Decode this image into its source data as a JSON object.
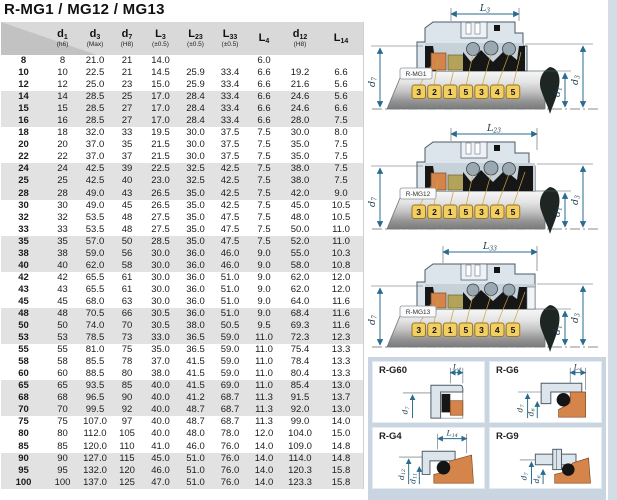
{
  "title": "R-MG1 / MG12 / MG13",
  "table": {
    "columns": [
      {
        "sym": "d",
        "sub": "1",
        "tol": "(h6)"
      },
      {
        "sym": "d",
        "sub": "3",
        "tol": "(Max)"
      },
      {
        "sym": "d",
        "sub": "7",
        "tol": "(H8)"
      },
      {
        "sym": "L",
        "sub": "3",
        "tol": "(±0.5)"
      },
      {
        "sym": "L",
        "sub": "23",
        "tol": "(±0.5)"
      },
      {
        "sym": "L",
        "sub": "33",
        "tol": "(±0.5)"
      },
      {
        "sym": "L",
        "sub": "4",
        "tol": ""
      },
      {
        "sym": "d",
        "sub": "12",
        "tol": "(H8)"
      },
      {
        "sym": "L",
        "sub": "14",
        "tol": ""
      }
    ],
    "rows": [
      {
        "label": "8",
        "values": [
          "8",
          "21.0",
          "21",
          "14.0",
          "",
          "",
          "6.0",
          "",
          ""
        ]
      },
      {
        "label": "10",
        "values": [
          "10",
          "22.5",
          "21",
          "14.5",
          "25.9",
          "33.4",
          "6.6",
          "19.2",
          "6.6"
        ]
      },
      {
        "label": "12",
        "values": [
          "12",
          "25.0",
          "23",
          "15.0",
          "25.9",
          "33.4",
          "6.6",
          "21.6",
          "5.6"
        ]
      },
      {
        "label": "14",
        "values": [
          "14",
          "28.5",
          "25",
          "17.0",
          "28.4",
          "33.4",
          "6.6",
          "24.6",
          "5.6"
        ]
      },
      {
        "label": "15",
        "values": [
          "15",
          "28.5",
          "27",
          "17.0",
          "28.4",
          "33.4",
          "6.6",
          "24.6",
          "6.6"
        ]
      },
      {
        "label": "16",
        "values": [
          "16",
          "28.5",
          "27",
          "17.0",
          "28.4",
          "33.4",
          "6.6",
          "28.0",
          "7.5"
        ]
      },
      {
        "label": "18",
        "values": [
          "18",
          "32.0",
          "33",
          "19.5",
          "30.0",
          "37.5",
          "7.5",
          "30.0",
          "8.0"
        ]
      },
      {
        "label": "20",
        "values": [
          "20",
          "37.0",
          "35",
          "21.5",
          "30.0",
          "37.5",
          "7.5",
          "35.0",
          "7.5"
        ]
      },
      {
        "label": "22",
        "values": [
          "22",
          "37.0",
          "37",
          "21.5",
          "30.0",
          "37.5",
          "7.5",
          "35.0",
          "7.5"
        ]
      },
      {
        "label": "24",
        "values": [
          "24",
          "42.5",
          "39",
          "22.5",
          "32.5",
          "42.5",
          "7.5",
          "38.0",
          "7.5"
        ]
      },
      {
        "label": "25",
        "values": [
          "25",
          "42.5",
          "40",
          "23.0",
          "32.5",
          "42.5",
          "7.5",
          "38.0",
          "7.5"
        ]
      },
      {
        "label": "28",
        "values": [
          "28",
          "49.0",
          "43",
          "26.5",
          "35.0",
          "42.5",
          "7.5",
          "42.0",
          "9.0"
        ]
      },
      {
        "label": "30",
        "values": [
          "30",
          "49.0",
          "45",
          "26.5",
          "35.0",
          "42.5",
          "7.5",
          "45.0",
          "10.5"
        ]
      },
      {
        "label": "32",
        "values": [
          "32",
          "53.5",
          "48",
          "27.5",
          "35.0",
          "47.5",
          "7.5",
          "48.0",
          "10.5"
        ]
      },
      {
        "label": "33",
        "values": [
          "33",
          "53.5",
          "48",
          "27.5",
          "35.0",
          "47.5",
          "7.5",
          "50.0",
          "11.0"
        ]
      },
      {
        "label": "35",
        "values": [
          "35",
          "57.0",
          "50",
          "28.5",
          "35.0",
          "47.5",
          "7.5",
          "52.0",
          "11.0"
        ]
      },
      {
        "label": "38",
        "values": [
          "38",
          "59.0",
          "56",
          "30.0",
          "36.0",
          "46.0",
          "9.0",
          "55.0",
          "10.3"
        ]
      },
      {
        "label": "40",
        "values": [
          "40",
          "62.0",
          "58",
          "30.0",
          "36.0",
          "46.0",
          "9.0",
          "58.0",
          "10.8"
        ]
      },
      {
        "label": "42",
        "values": [
          "42",
          "65.5",
          "61",
          "30.0",
          "36.0",
          "51.0",
          "9.0",
          "62.0",
          "12.0"
        ]
      },
      {
        "label": "43",
        "values": [
          "43",
          "65.5",
          "61",
          "30.0",
          "36.0",
          "51.0",
          "9.0",
          "62.0",
          "12.0"
        ]
      },
      {
        "label": "45",
        "values": [
          "45",
          "68.0",
          "63",
          "30.0",
          "36.0",
          "51.0",
          "9.0",
          "64.0",
          "11.6"
        ]
      },
      {
        "label": "48",
        "values": [
          "48",
          "70.5",
          "66",
          "30.5",
          "36.0",
          "51.0",
          "9.0",
          "68.4",
          "11.6"
        ]
      },
      {
        "label": "50",
        "values": [
          "50",
          "74.0",
          "70",
          "30.5",
          "38.0",
          "50.5",
          "9.5",
          "69.3",
          "11.6"
        ]
      },
      {
        "label": "53",
        "values": [
          "53",
          "78.5",
          "73",
          "33.0",
          "36.5",
          "59.0",
          "11.0",
          "72.3",
          "12.3"
        ]
      },
      {
        "label": "55",
        "values": [
          "55",
          "81.0",
          "75",
          "35.0",
          "36.5",
          "59.0",
          "11.0",
          "75.4",
          "13.3"
        ]
      },
      {
        "label": "58",
        "values": [
          "58",
          "85.5",
          "78",
          "37.0",
          "41.5",
          "59.0",
          "11.0",
          "78.4",
          "13.3"
        ]
      },
      {
        "label": "60",
        "values": [
          "60",
          "88.5",
          "80",
          "38.0",
          "41.5",
          "59.0",
          "11.0",
          "80.4",
          "13.3"
        ]
      },
      {
        "label": "65",
        "values": [
          "65",
          "93.5",
          "85",
          "40.0",
          "41.5",
          "69.0",
          "11.0",
          "85.4",
          "13.0"
        ]
      },
      {
        "label": "68",
        "values": [
          "68",
          "96.5",
          "90",
          "40.0",
          "41.2",
          "68.7",
          "11.3",
          "91.5",
          "13.7"
        ]
      },
      {
        "label": "70",
        "values": [
          "70",
          "99.5",
          "92",
          "40.0",
          "48.7",
          "68.7",
          "11.3",
          "92.0",
          "13.0"
        ]
      },
      {
        "label": "75",
        "values": [
          "75",
          "107.0",
          "97",
          "40.0",
          "48.7",
          "68.7",
          "11.3",
          "99.0",
          "14.0"
        ]
      },
      {
        "label": "80",
        "values": [
          "80",
          "112.0",
          "105",
          "40.0",
          "48.0",
          "78.0",
          "12.0",
          "104.0",
          "15.0"
        ]
      },
      {
        "label": "85",
        "values": [
          "85",
          "120.0",
          "110",
          "41.0",
          "46.0",
          "76.0",
          "14.0",
          "109.0",
          "14.8"
        ]
      },
      {
        "label": "90",
        "values": [
          "90",
          "127.0",
          "115",
          "45.0",
          "51.0",
          "76.0",
          "14.0",
          "114.0",
          "14.8"
        ]
      },
      {
        "label": "95",
        "values": [
          "95",
          "132.0",
          "120",
          "46.0",
          "51.0",
          "76.0",
          "14.0",
          "120.3",
          "15.8"
        ]
      },
      {
        "label": "100",
        "values": [
          "100",
          "137.0",
          "125",
          "47.0",
          "51.0",
          "76.0",
          "14.0",
          "123.3",
          "15.8"
        ]
      }
    ]
  },
  "diagrams": [
    {
      "label": "R-MG1",
      "top_dim": {
        "sym": "L",
        "sub": "3"
      },
      "left_dim": {
        "sym": "d",
        "sub": "7"
      },
      "right_dim_inner": {
        "sym": "d",
        "sub": "1"
      },
      "right_dim_outer": {
        "sym": "d",
        "sub": "3"
      },
      "tags": [
        "3",
        "2",
        "1",
        "5",
        "3",
        "4",
        "5"
      ]
    },
    {
      "label": "R-MG12",
      "top_dim": {
        "sym": "L",
        "sub": "23"
      },
      "left_dim": {
        "sym": "d",
        "sub": "7"
      },
      "right_dim_inner": {
        "sym": "d",
        "sub": "1"
      },
      "right_dim_outer": {
        "sym": "d",
        "sub": "3"
      },
      "tags": [
        "3",
        "2",
        "1",
        "5",
        "3",
        "4",
        "5"
      ]
    },
    {
      "label": "R-MG13",
      "top_dim": {
        "sym": "L",
        "sub": "33"
      },
      "left_dim": {
        "sym": "d",
        "sub": "7"
      },
      "right_dim_inner": {
        "sym": "d",
        "sub": "1"
      },
      "right_dim_outer": {
        "sym": "d",
        "sub": "3"
      },
      "tags": [
        "3",
        "2",
        "1",
        "5",
        "3",
        "4",
        "5"
      ]
    }
  ],
  "detail_panels": [
    {
      "label": "R-G60",
      "top_dim": {
        "sym": "L",
        "sub": "4"
      },
      "dims": [
        {
          "sym": "d",
          "sub": "7"
        }
      ]
    },
    {
      "label": "R-G6",
      "top_dim": {
        "sym": "L",
        "sub": "4"
      },
      "dims": [
        {
          "sym": "d",
          "sub": "7"
        },
        {
          "sym": "d",
          "sub": "6"
        }
      ]
    },
    {
      "label": "R-G4",
      "top_dim": {
        "sym": "L",
        "sub": "14"
      },
      "dims": [
        {
          "sym": "d",
          "sub": "12"
        },
        {
          "sym": "d",
          "sub": "11"
        }
      ]
    },
    {
      "label": "R-G9",
      "dims": [
        {
          "sym": "d",
          "sub": "7"
        },
        {
          "sym": "d",
          "sub": "6"
        }
      ]
    }
  ],
  "colors": {
    "header_gray": "#d9d9d9",
    "row_stripe": "#e2e2e2",
    "panel_bg": "#c9d5e0",
    "steel": "#dce5ec",
    "seat_orange": "#d6854a",
    "carbon_olive": "#b2a35c",
    "tag_yellow": "#f2cf63",
    "dim_blue": "#2a6b8f",
    "elastomer_black": "#161616"
  }
}
